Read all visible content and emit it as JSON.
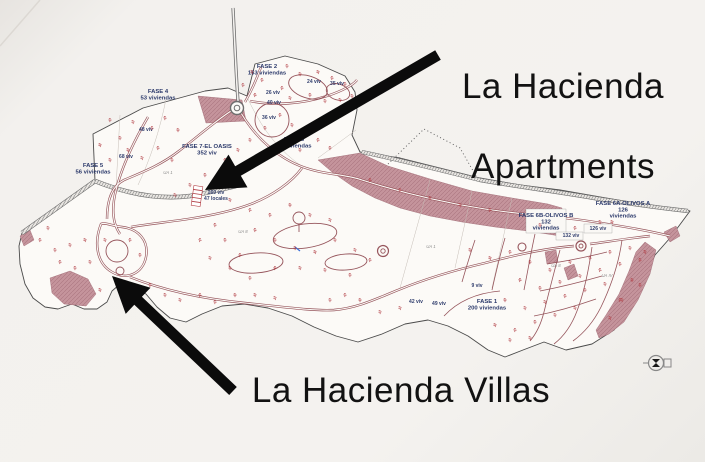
{
  "titles": {
    "apartments": [
      "La Hacienda",
      "Apartments"
    ],
    "villas": "La Hacienda Villas"
  },
  "colors": {
    "paper": "#f4f2ef",
    "map_fill": "#fcfaf7",
    "zone_pink": "#c5949c",
    "road_maroon": "#96555c",
    "road_gray": "#7a7a7a",
    "label_navy": "#2c3a6b",
    "mark_red": "#b13b42",
    "arrow_black": "#0b0b0b"
  },
  "map": {
    "phase_labels": [
      {
        "lines": [
          "FASE 4",
          "53 viviendas"
        ],
        "x": 158,
        "y": 93
      },
      {
        "lines": [
          "FASE 2",
          "153 viviendas"
        ],
        "x": 267,
        "y": 68
      },
      {
        "lines": [
          "FASE 5",
          "56 viviendas"
        ],
        "x": 93,
        "y": 167
      },
      {
        "lines": [
          "FASE 7-EL OASIS",
          "352 viv"
        ],
        "x": 207,
        "y": 148
      },
      {
        "lines": [
          "FASE 3",
          "92 viviendas"
        ],
        "x": 294,
        "y": 141
      },
      {
        "lines": [
          "FASE 6B-OLIVOS B",
          "132",
          "viviendas"
        ],
        "x": 546,
        "y": 217
      },
      {
        "lines": [
          "FASE 6A-OLIVOS A",
          "126",
          "viviendas"
        ],
        "x": 623,
        "y": 205
      },
      {
        "lines": [
          "FASE 1",
          "200 viviendas"
        ],
        "x": 487,
        "y": 303
      }
    ],
    "unit_labels": [
      {
        "text": "24 viv",
        "x": 314,
        "y": 83
      },
      {
        "text": "35 viv",
        "x": 337,
        "y": 85
      },
      {
        "text": "26 viv",
        "x": 273,
        "y": 94
      },
      {
        "text": "40 viv",
        "x": 274,
        "y": 104
      },
      {
        "text": "36 viv",
        "x": 269,
        "y": 119
      },
      {
        "text": "48 viv",
        "x": 146,
        "y": 131
      },
      {
        "text": "68 viv",
        "x": 126,
        "y": 158
      },
      {
        "text": "160 viv",
        "x": 216,
        "y": 194
      },
      {
        "text": "47 locales",
        "x": 216,
        "y": 200
      },
      {
        "text": "126 viv",
        "x": 598,
        "y": 230
      },
      {
        "text": "132 viv",
        "x": 571,
        "y": 237
      },
      {
        "text": "9 viv",
        "x": 477,
        "y": 287
      },
      {
        "text": "42 viv",
        "x": 416,
        "y": 303
      },
      {
        "text": "49 viv",
        "x": 439,
        "y": 305
      }
    ],
    "area_labels": [
      {
        "text": "UA 1",
        "x": 168,
        "y": 174
      },
      {
        "text": "UA 8",
        "x": 243,
        "y": 233
      },
      {
        "text": "UA 1",
        "x": 431,
        "y": 248
      },
      {
        "text": "UA 8",
        "x": 556,
        "y": 267
      },
      {
        "text": "UA IV",
        "x": 607,
        "y": 277
      }
    ],
    "plot_marks": [
      [
        252,
        72
      ],
      [
        262,
        80
      ],
      [
        287,
        66
      ],
      [
        300,
        74
      ],
      [
        318,
        72
      ],
      [
        332,
        78
      ],
      [
        345,
        84
      ],
      [
        352,
        96
      ],
      [
        290,
        98
      ],
      [
        282,
        88
      ],
      [
        310,
        95
      ],
      [
        325,
        101
      ],
      [
        340,
        100
      ],
      [
        255,
        95
      ],
      [
        110,
        120
      ],
      [
        120,
        138
      ],
      [
        133,
        122
      ],
      [
        152,
        128
      ],
      [
        165,
        118
      ],
      [
        178,
        130
      ],
      [
        128,
        150
      ],
      [
        142,
        158
      ],
      [
        158,
        148
      ],
      [
        172,
        160
      ],
      [
        110,
        160
      ],
      [
        100,
        145
      ],
      [
        280,
        115
      ],
      [
        265,
        128
      ],
      [
        292,
        125
      ],
      [
        305,
        132
      ],
      [
        318,
        140
      ],
      [
        330,
        148
      ],
      [
        250,
        140
      ],
      [
        238,
        150
      ],
      [
        225,
        160
      ],
      [
        260,
        155
      ],
      [
        300,
        150
      ],
      [
        230,
        200
      ],
      [
        250,
        210
      ],
      [
        270,
        215
      ],
      [
        290,
        205
      ],
      [
        310,
        215
      ],
      [
        330,
        220
      ],
      [
        255,
        230
      ],
      [
        275,
        240
      ],
      [
        295,
        248
      ],
      [
        315,
        252
      ],
      [
        240,
        255
      ],
      [
        225,
        240
      ],
      [
        335,
        240
      ],
      [
        355,
        250
      ],
      [
        370,
        260
      ],
      [
        350,
        275
      ],
      [
        325,
        270
      ],
      [
        300,
        268
      ],
      [
        275,
        268
      ],
      [
        250,
        278
      ],
      [
        230,
        268
      ],
      [
        210,
        258
      ],
      [
        200,
        240
      ],
      [
        215,
        225
      ],
      [
        360,
        300
      ],
      [
        380,
        312
      ],
      [
        400,
        308
      ],
      [
        345,
        295
      ],
      [
        330,
        300
      ],
      [
        470,
        250
      ],
      [
        490,
        258
      ],
      [
        510,
        252
      ],
      [
        530,
        262
      ],
      [
        550,
        270
      ],
      [
        570,
        262
      ],
      [
        590,
        258
      ],
      [
        610,
        252
      ],
      [
        630,
        248
      ],
      [
        645,
        252
      ],
      [
        520,
        280
      ],
      [
        540,
        288
      ],
      [
        560,
        282
      ],
      [
        580,
        276
      ],
      [
        600,
        270
      ],
      [
        620,
        264
      ],
      [
        505,
        300
      ],
      [
        525,
        308
      ],
      [
        545,
        302
      ],
      [
        565,
        296
      ],
      [
        585,
        290
      ],
      [
        605,
        284
      ],
      [
        495,
        325
      ],
      [
        515,
        330
      ],
      [
        535,
        322
      ],
      [
        555,
        315
      ],
      [
        575,
        308
      ],
      [
        620,
        300
      ],
      [
        640,
        285
      ],
      [
        510,
        340
      ],
      [
        530,
        338
      ],
      [
        370,
        180
      ],
      [
        400,
        190
      ],
      [
        430,
        198
      ],
      [
        460,
        205
      ],
      [
        490,
        210
      ],
      [
        640,
        260
      ],
      [
        632,
        280
      ],
      [
        622,
        300
      ],
      [
        610,
        318
      ],
      [
        40,
        240
      ],
      [
        55,
        250
      ],
      [
        70,
        245
      ],
      [
        85,
        240
      ],
      [
        60,
        262
      ],
      [
        75,
        268
      ],
      [
        90,
        262
      ],
      [
        105,
        240
      ],
      [
        130,
        240
      ],
      [
        140,
        255
      ],
      [
        48,
        228
      ],
      [
        100,
        290
      ],
      [
        130,
        290
      ],
      [
        150,
        285
      ],
      [
        165,
        295
      ],
      [
        180,
        300
      ],
      [
        200,
        295
      ],
      [
        215,
        302
      ],
      [
        235,
        295
      ],
      [
        255,
        295
      ],
      [
        275,
        298
      ],
      [
        243,
        85
      ],
      [
        540,
        225
      ],
      [
        600,
        222
      ],
      [
        612,
        222
      ],
      [
        575,
        228
      ],
      [
        205,
        175
      ],
      [
        190,
        185
      ],
      [
        175,
        195
      ]
    ]
  }
}
